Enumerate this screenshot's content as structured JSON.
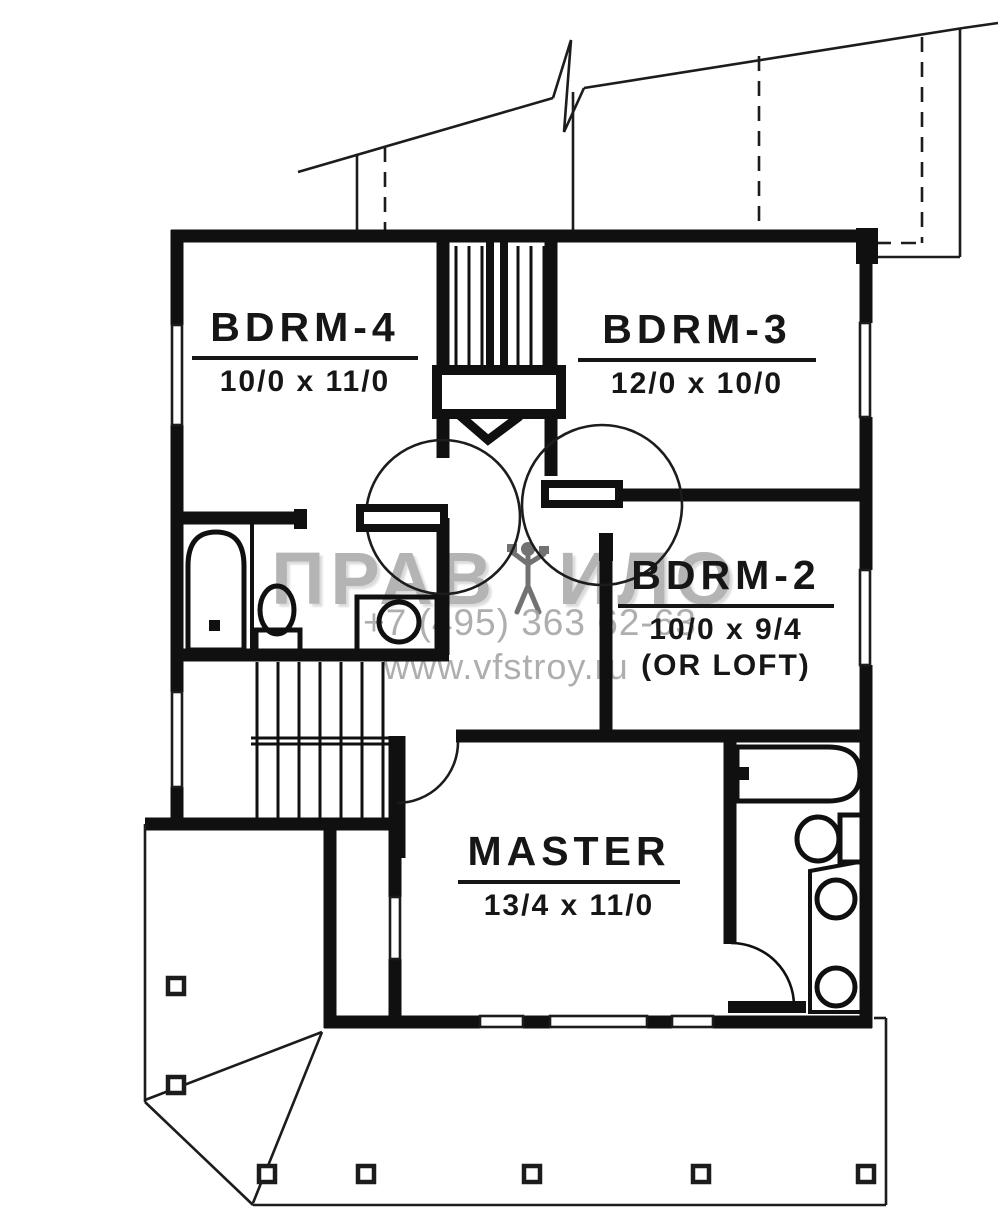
{
  "page": {
    "background": "#ffffff",
    "ink_color": "#141414",
    "watermark_color": "#9c9c9c",
    "drawing_kind": "second floor plan"
  },
  "watermark": {
    "brand_prefix": "ПРАВ",
    "brand_suffix": "ИЛО",
    "figure_icon": "watermark-figure-icon",
    "phone": "+7 (495) 363 62-63",
    "website": "www.vfstroy.ru"
  },
  "rooms": {
    "bdrm4": {
      "label": "BDRM-4",
      "dims": "10/0 x 11/0"
    },
    "bdrm3": {
      "label": "BDRM-3",
      "dims": "12/0 x 10/0"
    },
    "bdrm2": {
      "label": "BDRM-2",
      "dims": "10/0 x 9/4",
      "note": "(OR LOFT)"
    },
    "master": {
      "label": "MASTER",
      "dims": "13/4 x 11/0"
    }
  },
  "symbols": {
    "fixtures": [
      "bathtub",
      "toilet",
      "sink-vanity",
      "double-sink-vanity",
      "staircase-upper",
      "staircase-lower",
      "door-swing",
      "deck-post",
      "roof-break-line",
      "window"
    ]
  }
}
